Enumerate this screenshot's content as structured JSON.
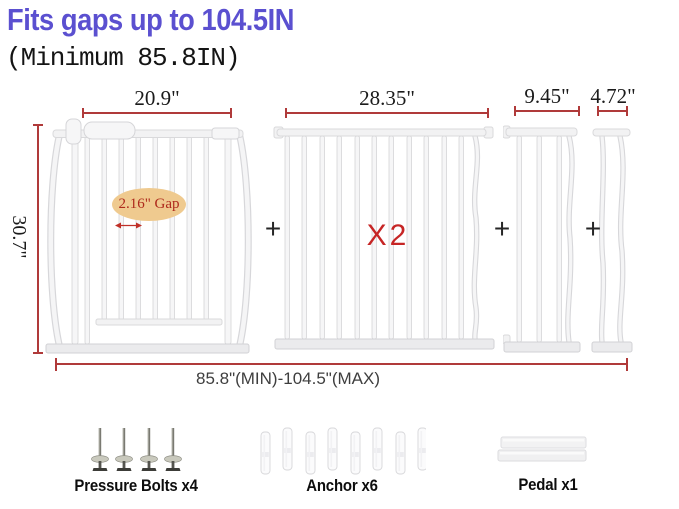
{
  "header": {
    "title": "Fits gaps up to 104.5IN",
    "subtitle": "(Minimum 85.8IN)"
  },
  "colors": {
    "title_text": "#5b50d0",
    "dimension_lines": "#b03a3a",
    "quantity_text": "#c62525",
    "gap_bubble_background": "#efca8f",
    "gap_bubble_text": "#ae2a1c",
    "gate_metal": "#f6f6f7",
    "background": "#ffffff"
  },
  "diagram": {
    "main_gate": {
      "width_label": "20.9\"",
      "height_label": "30.7\"",
      "gap_label": "2.16\" Gap"
    },
    "extension_large": {
      "width_label": "28.35\"",
      "quantity_label": "X2"
    },
    "extension_medium": {
      "width_label": "9.45\""
    },
    "extension_small": {
      "width_label": "4.72\""
    },
    "plus_sign": "+",
    "total_range_label": "85.8\"(MIN)-104.5\"(MAX)"
  },
  "accessories": {
    "pressure_bolts": {
      "label": "Pressure Bolts x4",
      "count_shown": 4
    },
    "anchors": {
      "label": "Anchor x6",
      "count_shown": 8
    },
    "pedal": {
      "label": "Pedal x1",
      "count_shown": 1
    }
  }
}
